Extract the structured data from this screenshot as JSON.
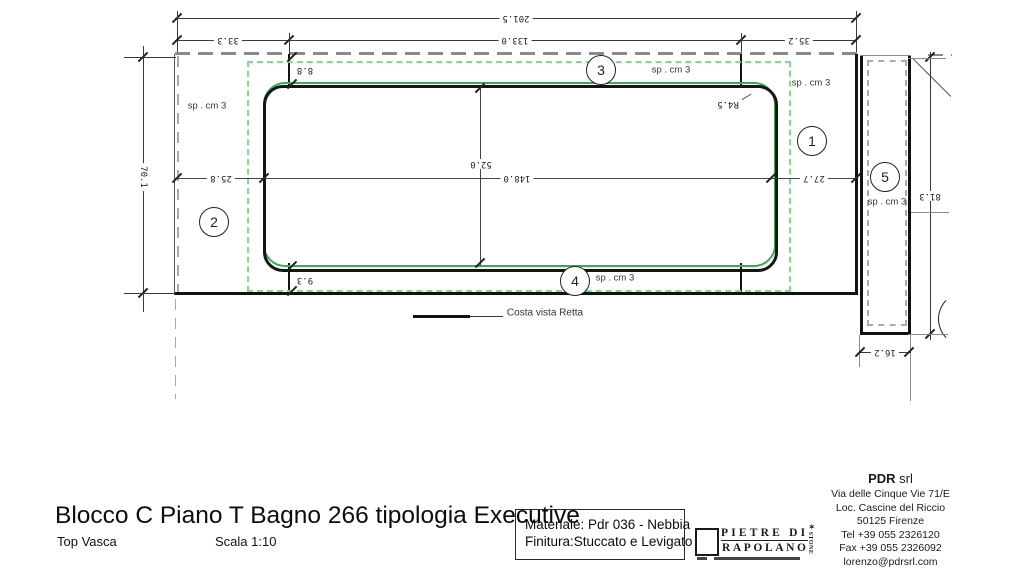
{
  "drawing": {
    "dims": {
      "total": "201.5",
      "seg1": "33.3",
      "seg2": "133.0",
      "seg3": "35.2",
      "slab_h": "70.1",
      "basin_w": "148.0",
      "basin_h": "52.0",
      "m_left": "25.8",
      "m_right": "27.7",
      "m_top": "8.8",
      "m_bottom": "9.3",
      "side_h": "81.3",
      "side_w": "16.2",
      "radius": "R4.5"
    },
    "thickness_label": "sp . cm 3",
    "balloons": {
      "b1": "1",
      "b2": "2",
      "b3": "3",
      "b4": "4",
      "b5": "5"
    },
    "legend": {
      "costa": "Costa vista Retta"
    }
  },
  "title_block": {
    "title": "Blocco C Piano T Bagno 266 tipologia Executive",
    "subtitle": "Top Vasca",
    "scale": "Scala 1:10"
  },
  "material_box": {
    "materiale": "Materiale: Pdr 036 - Nebbia",
    "finitura": "Finitura:Stuccato e Levigato"
  },
  "logo": {
    "line1": "PIETRE DI",
    "line2": "RAPOLANO",
    "vertical": "STONE",
    "mark": "✶"
  },
  "company": {
    "name": "PDR",
    "suffix": " srl",
    "lines": [
      "Via delle Cinque Vie 71/E",
      "Loc. Cascine del Riccio",
      "50125 Firenze",
      "Tel +39  055 2326120",
      "Fax +39 055 2326092",
      "lorenzo@pdrsrl.com"
    ]
  },
  "colors": {
    "basin_green": "#3aae4a",
    "green_dashed": "#86d986",
    "hidden_gray": "#a8a8a8"
  }
}
